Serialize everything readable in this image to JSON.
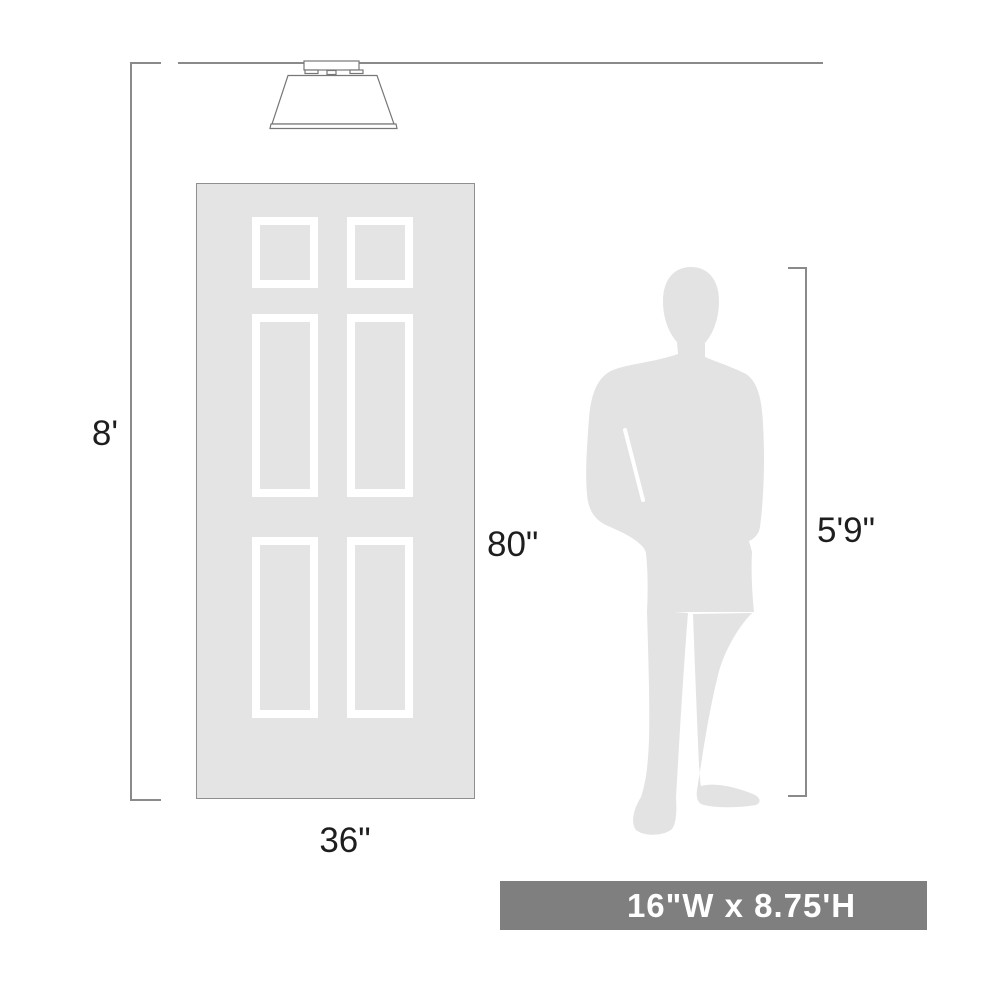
{
  "diagram": {
    "type": "product-scale-dimension-diagram",
    "ceiling_height_label": "8'",
    "door": {
      "height_label": "80\"",
      "width_label": "36\"",
      "panel_count": 6
    },
    "person": {
      "height_label": "5'9\""
    },
    "fixture": {
      "icon": "flush-mount-ceiling-light-icon"
    },
    "banner": {
      "text": "16\"W x 8.75'H"
    },
    "colors": {
      "background": "#ffffff",
      "line": "#8a8a8a",
      "outline": "#777777",
      "door_fill": "#e4e4e4",
      "door_border": "#8f8f8f",
      "silhouette": "#e3e3e4",
      "panel_frame": "#ffffff",
      "text": "#1e1e1e",
      "banner_bg": "#7f7f7f",
      "banner_text": "#ffffff"
    }
  }
}
